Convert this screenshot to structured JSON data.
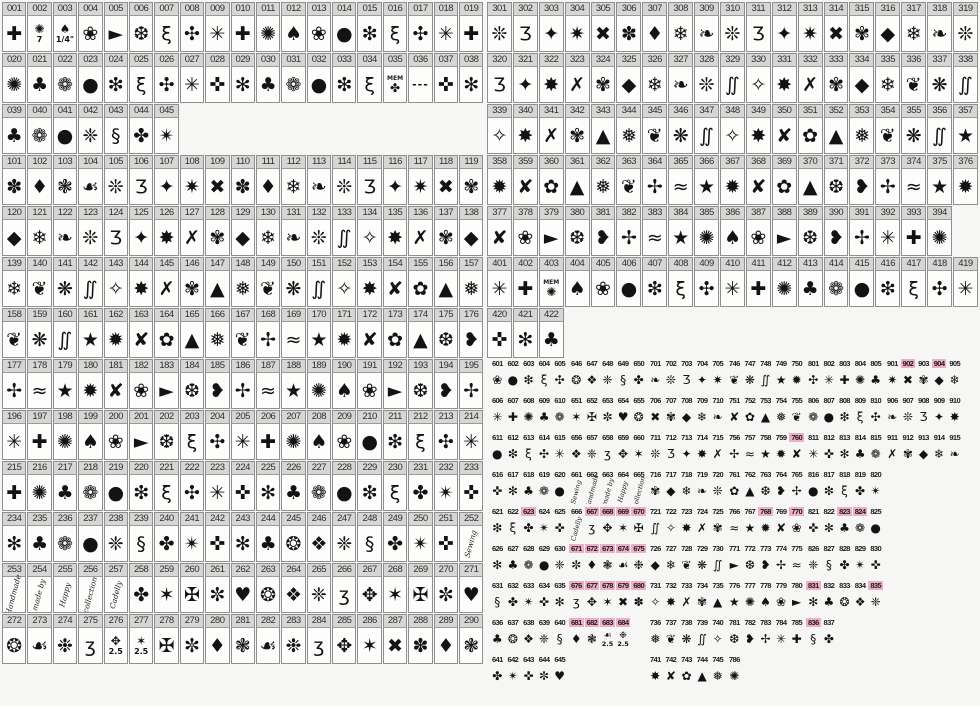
{
  "colors": {
    "page_background": "#f6f6f4",
    "cell_background": "#fdfdfc",
    "cell_border": "#8f8f8f",
    "number_bar_background": "#d6d6d4",
    "number_text": "#2e2e2e",
    "glyph_ink": "#131313",
    "highlight_pink": "#efaec7"
  },
  "left_grid": {
    "rows": [
      [
        "001",
        "002",
        "003",
        "004",
        "005",
        "006",
        "007",
        "008",
        "009",
        "010",
        "011",
        "012",
        "013",
        "014",
        "015",
        "016",
        "017",
        "018",
        "019"
      ],
      [
        "020",
        "021",
        "022",
        "023",
        "024",
        "025",
        "026",
        "027",
        "028",
        "029",
        "030",
        "031",
        "032",
        "033",
        "034",
        "035",
        "036",
        "037",
        "038"
      ],
      [
        "039",
        "040",
        "041",
        "042",
        "043",
        "044",
        "045"
      ],
      [
        "101",
        "102",
        "103",
        "104",
        "105",
        "106",
        "107",
        "108",
        "109",
        "110",
        "111",
        "112",
        "113",
        "114",
        "115",
        "116",
        "117",
        "118",
        "119"
      ],
      [
        "120",
        "121",
        "122",
        "123",
        "124",
        "125",
        "126",
        "127",
        "128",
        "129",
        "130",
        "131",
        "132",
        "133",
        "134",
        "135",
        "136",
        "137",
        "138"
      ],
      [
        "139",
        "140",
        "141",
        "142",
        "143",
        "144",
        "145",
        "146",
        "147",
        "148",
        "149",
        "150",
        "151",
        "152",
        "153",
        "154",
        "155",
        "156",
        "157"
      ],
      [
        "158",
        "159",
        "160",
        "161",
        "162",
        "163",
        "164",
        "165",
        "166",
        "167",
        "168",
        "169",
        "170",
        "171",
        "172",
        "173",
        "174",
        "175",
        "176"
      ],
      [
        "177",
        "178",
        "179",
        "180",
        "181",
        "182",
        "183",
        "184",
        "185",
        "186",
        "187",
        "188",
        "189",
        "190",
        "191",
        "192",
        "193",
        "194",
        "195"
      ],
      [
        "196",
        "197",
        "198",
        "199",
        "200",
        "201",
        "202",
        "203",
        "204",
        "205",
        "206",
        "207",
        "208",
        "209",
        "210",
        "211",
        "212",
        "213",
        "214"
      ],
      [
        "215",
        "216",
        "217",
        "218",
        "219",
        "220",
        "221",
        "222",
        "223",
        "224",
        "225",
        "226",
        "227",
        "228",
        "229",
        "230",
        "231",
        "232",
        "233"
      ],
      [
        "234",
        "235",
        "236",
        "237",
        "238",
        "239",
        "240",
        "241",
        "242",
        "243",
        "244",
        "245",
        "246",
        "247",
        "248",
        "249",
        "250",
        "251",
        "252"
      ],
      [
        "253",
        "254",
        "255",
        "256",
        "257",
        "258",
        "259",
        "260",
        "261",
        "262",
        "263",
        "264",
        "265",
        "266",
        "267",
        "268",
        "269",
        "270",
        "271"
      ],
      [
        "272",
        "273",
        "274",
        "275",
        "276",
        "277",
        "278",
        "279",
        "280",
        "281",
        "282",
        "283",
        "284",
        "285",
        "286",
        "287",
        "288",
        "289",
        "290"
      ]
    ]
  },
  "right_grid": {
    "rows": [
      [
        "301",
        "302",
        "303",
        "304",
        "305",
        "306",
        "307",
        "308",
        "309",
        "310",
        "311",
        "312",
        "313",
        "314",
        "315",
        "316",
        "317",
        "318",
        "319"
      ],
      [
        "320",
        "321",
        "322",
        "323",
        "324",
        "325",
        "326",
        "327",
        "328",
        "329",
        "330",
        "331",
        "332",
        "333",
        "334",
        "335",
        "336",
        "337",
        "338"
      ],
      [
        "339",
        "340",
        "341",
        "342",
        "343",
        "344",
        "345",
        "346",
        "347",
        "348",
        "349",
        "350",
        "351",
        "352",
        "353",
        "354",
        "355",
        "356",
        "357"
      ],
      [
        "358",
        "359",
        "360",
        "361",
        "362",
        "363",
        "364",
        "365",
        "366",
        "367",
        "368",
        "369",
        "370",
        "371",
        "372",
        "373",
        "374",
        "375",
        "376"
      ],
      [
        "377",
        "378",
        "379",
        "380",
        "381",
        "382",
        "383",
        "384",
        "385",
        "386",
        "387",
        "388",
        "389",
        "390",
        "391",
        "392",
        "393",
        "394"
      ],
      [
        "401",
        "402",
        "403",
        "404",
        "405",
        "406",
        "407",
        "408",
        "409",
        "410",
        "411",
        "412",
        "413",
        "414",
        "415",
        "416",
        "417",
        "418",
        "419"
      ],
      [
        "420",
        "421",
        "422"
      ]
    ]
  },
  "small_grid": {
    "rows": [
      [
        [
          "601",
          "602",
          "603",
          "604",
          "605"
        ],
        [
          "646",
          "647",
          "648",
          "649",
          "650"
        ],
        [
          "701",
          "702",
          "703",
          "704",
          "705"
        ],
        [
          "746",
          "747",
          "748",
          "749",
          "750"
        ],
        [
          "801",
          "802",
          "803",
          "804",
          "805"
        ],
        [
          "901",
          "902",
          "903",
          "904",
          "905"
        ]
      ],
      [
        [
          "606",
          "607",
          "608",
          "609",
          "610"
        ],
        [
          "651",
          "652",
          "653",
          "654",
          "655"
        ],
        [
          "706",
          "707",
          "708",
          "709",
          "710"
        ],
        [
          "751",
          "752",
          "753",
          "754",
          "755"
        ],
        [
          "806",
          "807",
          "808",
          "809",
          "810"
        ],
        [
          "906",
          "907",
          "908",
          "909",
          "910"
        ]
      ],
      [
        [
          "611",
          "612",
          "613",
          "614",
          "615"
        ],
        [
          "656",
          "657",
          "658",
          "659",
          "660"
        ],
        [
          "711",
          "712",
          "713",
          "714",
          "715"
        ],
        [
          "756",
          "757",
          "758",
          "759",
          "760"
        ],
        [
          "811",
          "812",
          "813",
          "814",
          "815"
        ],
        [
          "911",
          "912",
          "913",
          "914",
          "915"
        ]
      ],
      [
        [
          "616",
          "617",
          "618",
          "619",
          "620"
        ],
        [
          "661",
          "662",
          "663",
          "664",
          "665"
        ],
        [
          "716",
          "717",
          "718",
          "719",
          "720"
        ],
        [
          "761",
          "762",
          "763",
          "764",
          "765"
        ],
        [
          "816",
          "817",
          "818",
          "819",
          "820"
        ],
        []
      ],
      [
        [
          "621",
          "622",
          "623",
          "624",
          "625"
        ],
        [
          "666",
          "667",
          "668",
          "669",
          "670"
        ],
        [
          "721",
          "722",
          "723",
          "724",
          "725"
        ],
        [
          "766",
          "767",
          "768",
          "769",
          "770"
        ],
        [
          "821",
          "822",
          "823",
          "824",
          "825"
        ],
        []
      ],
      [
        [
          "626",
          "627",
          "628",
          "629",
          "630"
        ],
        [
          "671",
          "672",
          "673",
          "674",
          "675"
        ],
        [
          "726",
          "727",
          "728",
          "729",
          "730"
        ],
        [
          "771",
          "772",
          "773",
          "774",
          "775"
        ],
        [
          "826",
          "827",
          "828",
          "829",
          "830"
        ],
        []
      ],
      [
        [
          "631",
          "632",
          "633",
          "634",
          "635"
        ],
        [
          "676",
          "677",
          "678",
          "679",
          "680"
        ],
        [
          "731",
          "732",
          "733",
          "734",
          "735"
        ],
        [
          "776",
          "777",
          "778",
          "779",
          "780"
        ],
        [
          "831",
          "832",
          "833",
          "834",
          "835"
        ],
        []
      ],
      [
        [
          "636",
          "637",
          "638",
          "639",
          "640"
        ],
        [
          "681",
          "682",
          "683",
          "684"
        ],
        [
          "736",
          "737",
          "738",
          "739",
          "740"
        ],
        [
          "781",
          "782",
          "783",
          "784",
          "785"
        ],
        [
          "836",
          "837"
        ],
        []
      ],
      [
        [
          "641",
          "642",
          "643",
          "644",
          "645"
        ],
        [],
        [
          "741",
          "742",
          "743",
          "744",
          "745"
        ],
        [
          "786"
        ],
        [],
        []
      ]
    ]
  },
  "highlighted": [
    "623",
    "667",
    "668",
    "669",
    "670",
    "671",
    "672",
    "673",
    "674",
    "675",
    "676",
    "677",
    "678",
    "679",
    "680",
    "681",
    "682",
    "683",
    "684",
    "760",
    "768",
    "770",
    "823",
    "824",
    "831",
    "835",
    "836",
    "902",
    "904"
  ],
  "script_cells": {
    "252": "Sewing",
    "253": "Handmade",
    "254": "made by",
    "255": "Happy",
    "256": "collection",
    "257": "Cadelly",
    "661": "Sewing",
    "662": "Handmade",
    "663": "made by",
    "664": "Happy",
    "665": "collection",
    "666": "Cadelly"
  },
  "notes_above": {
    "035": "MEM",
    "403": "MEM"
  },
  "notes_below": {
    "002": "7",
    "003": "1/4\"",
    "276": "2.5",
    "277": "2.5",
    "683": "2.5",
    "684": "2.5"
  },
  "glyph_overrides": {
    "036": "---"
  },
  "glyph_palette": [
    "✳",
    "✴",
    "✶",
    "✷",
    "✸",
    "✹",
    "✺",
    "✻",
    "✼",
    "✽",
    "✾",
    "✿",
    "❀",
    "❁",
    "❂",
    "❃",
    "❄",
    "❅",
    "❆",
    "❇",
    "❈",
    "❉",
    "❊",
    "❋",
    "✢",
    "✣",
    "✤",
    "✥",
    "✦",
    "✧",
    "★",
    "✚",
    "✜",
    "✠",
    "✖",
    "✗",
    "✘",
    "♠",
    "♣",
    "♥",
    "♦",
    "◆",
    "▲",
    "►",
    "●",
    "❖",
    "☙",
    "❧",
    "❦",
    "❥",
    "ξ",
    "§",
    "ʒ",
    "Ʒ",
    "∬",
    "≈"
  ]
}
